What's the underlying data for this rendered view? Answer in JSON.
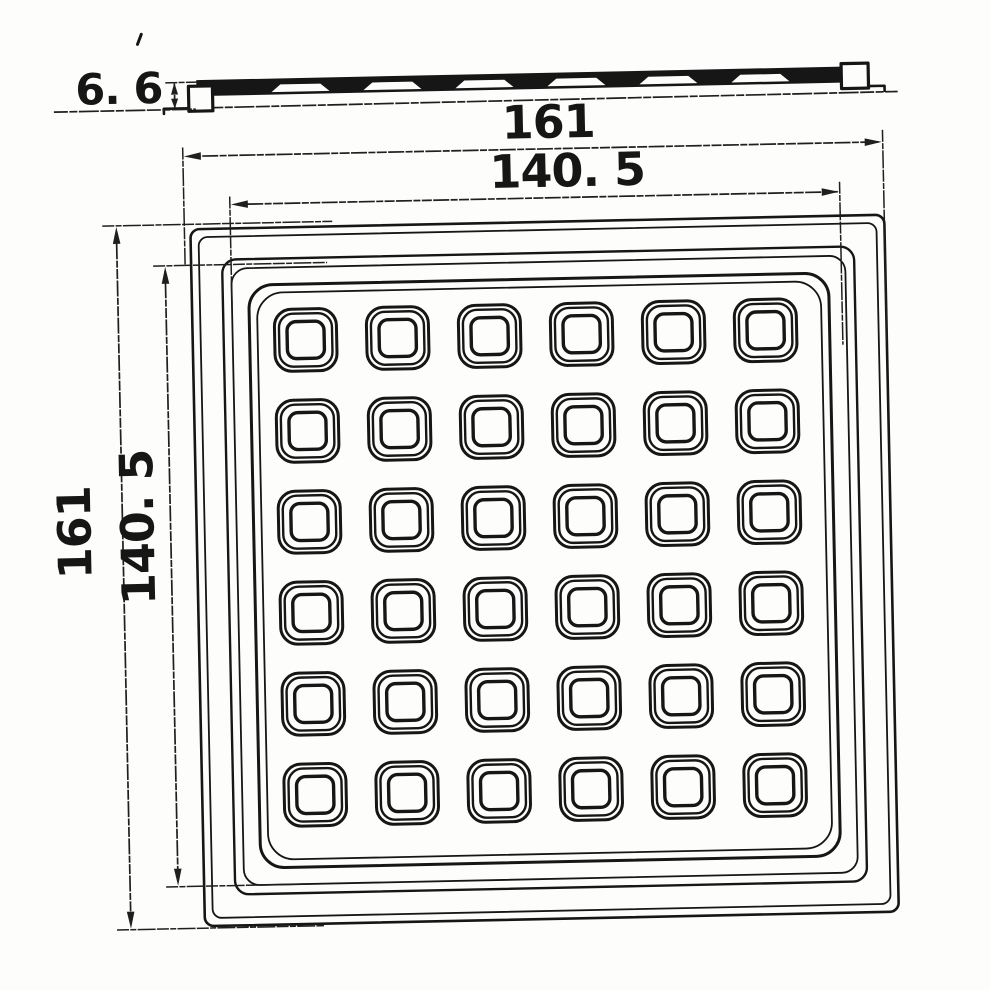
{
  "drawing": {
    "description": "engineering drawing of square tray with 6x6 grid of square cells, plan view and side section view",
    "labels": {
      "profile_height": "6. 6",
      "outer_width": "161",
      "cavity_width": "140. 5",
      "outer_height": "161",
      "cavity_height": "140. 5"
    },
    "colors": {
      "line": "#161616",
      "dim": "#1f1f1f",
      "paper": "#fdfdfc"
    },
    "rotation_deg": -1.2,
    "plan": {
      "x": 196,
      "y": 223,
      "w": 694,
      "h": 697,
      "rings": [
        [
          0,
          9,
          2.6
        ],
        [
          8,
          9,
          1.8
        ],
        [
          31,
          14,
          2.4
        ],
        [
          40,
          16,
          1.8
        ],
        [
          57,
          24,
          3.0
        ],
        [
          65,
          26,
          1.8
        ]
      ]
    },
    "grid": {
      "rows": 6,
      "cols": 6,
      "col_centers": [
        309,
        401,
        493,
        585,
        677,
        769
      ],
      "row_centers": [
        336,
        427,
        518,
        609,
        700,
        791
      ],
      "cell_rings": [
        {
          "s": 62,
          "r": 17,
          "sw": 3.0
        },
        {
          "s": 53,
          "r": 14,
          "sw": 2.4
        },
        {
          "s": 37,
          "r": 9,
          "sw": 3.4
        }
      ]
    },
    "profile": {
      "band": {
        "x1": 205,
        "x2": 873,
        "top": 74,
        "bottom": 90
      },
      "notch": {
        "top_y": 80,
        "bottom_y": 87.5,
        "half_top": 20,
        "half_bottom": 29
      }
    }
  }
}
